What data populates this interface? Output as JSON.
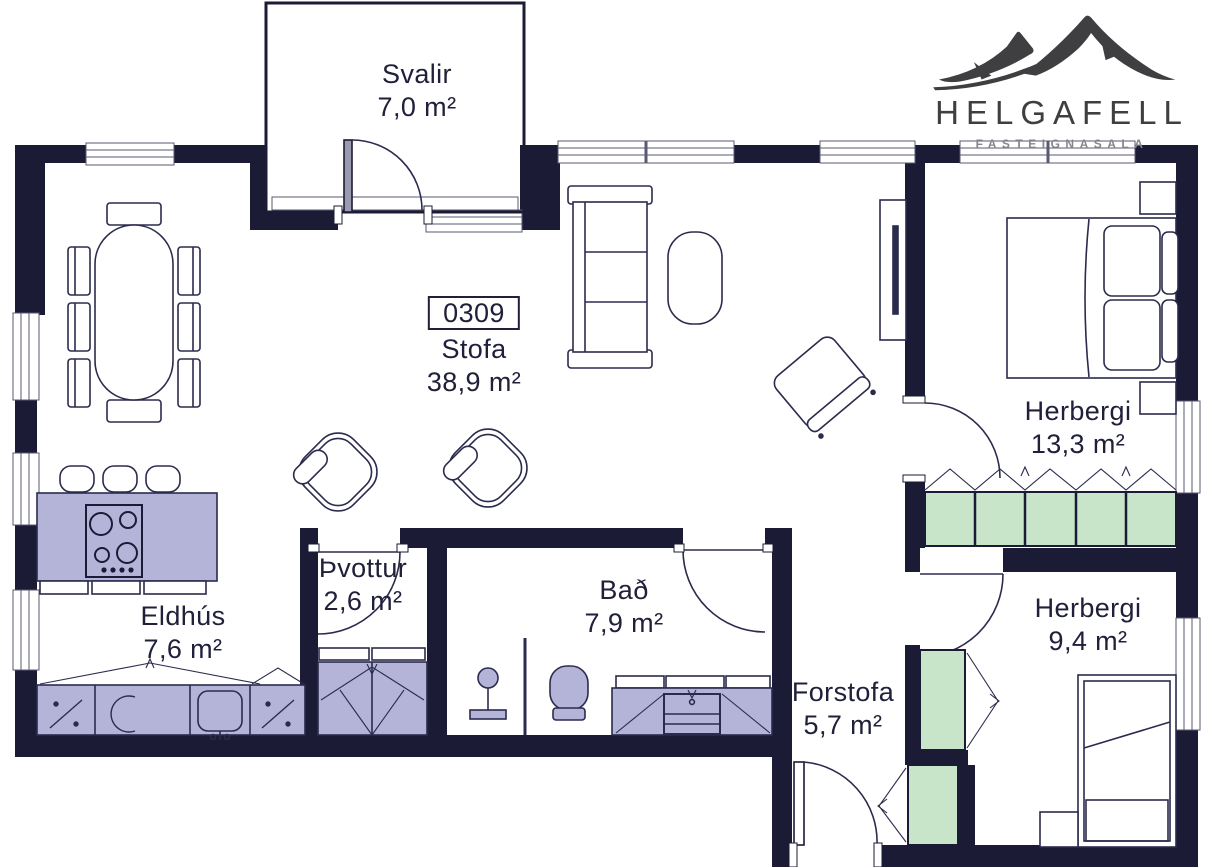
{
  "logo": {
    "brand": "HELGAFELL",
    "tagline": "FASTEIGNASALA",
    "icon": "mountain-logo-icon"
  },
  "rooms": [
    {
      "id": "svalir",
      "name": "Svalir",
      "area": "7,0 m²"
    },
    {
      "id": "stofa",
      "name": "Stofa",
      "area": "38,9 m²",
      "number": "0309"
    },
    {
      "id": "herbergi-1",
      "name": "Herbergi",
      "area": "13,3 m²"
    },
    {
      "id": "herbergi-2",
      "name": "Herbergi",
      "area": "9,4 m²"
    },
    {
      "id": "thvottur",
      "name": "Þvottur",
      "area": "2,6 m²"
    },
    {
      "id": "bad",
      "name": "Bað",
      "area": "7,9 m²"
    },
    {
      "id": "eldhus",
      "name": "Eldhús",
      "area": "7,6 m²"
    },
    {
      "id": "forstofa",
      "name": "Forstofa",
      "area": "5,7 m²"
    }
  ],
  "colors": {
    "wall": "#1b1b35",
    "furniture_line": "#2b2b4d",
    "cabinet_fill": "#b4b4d9",
    "wardrobe_fill": "#c8e4c9",
    "logo": "#3f3f41",
    "text": "#20203a"
  }
}
